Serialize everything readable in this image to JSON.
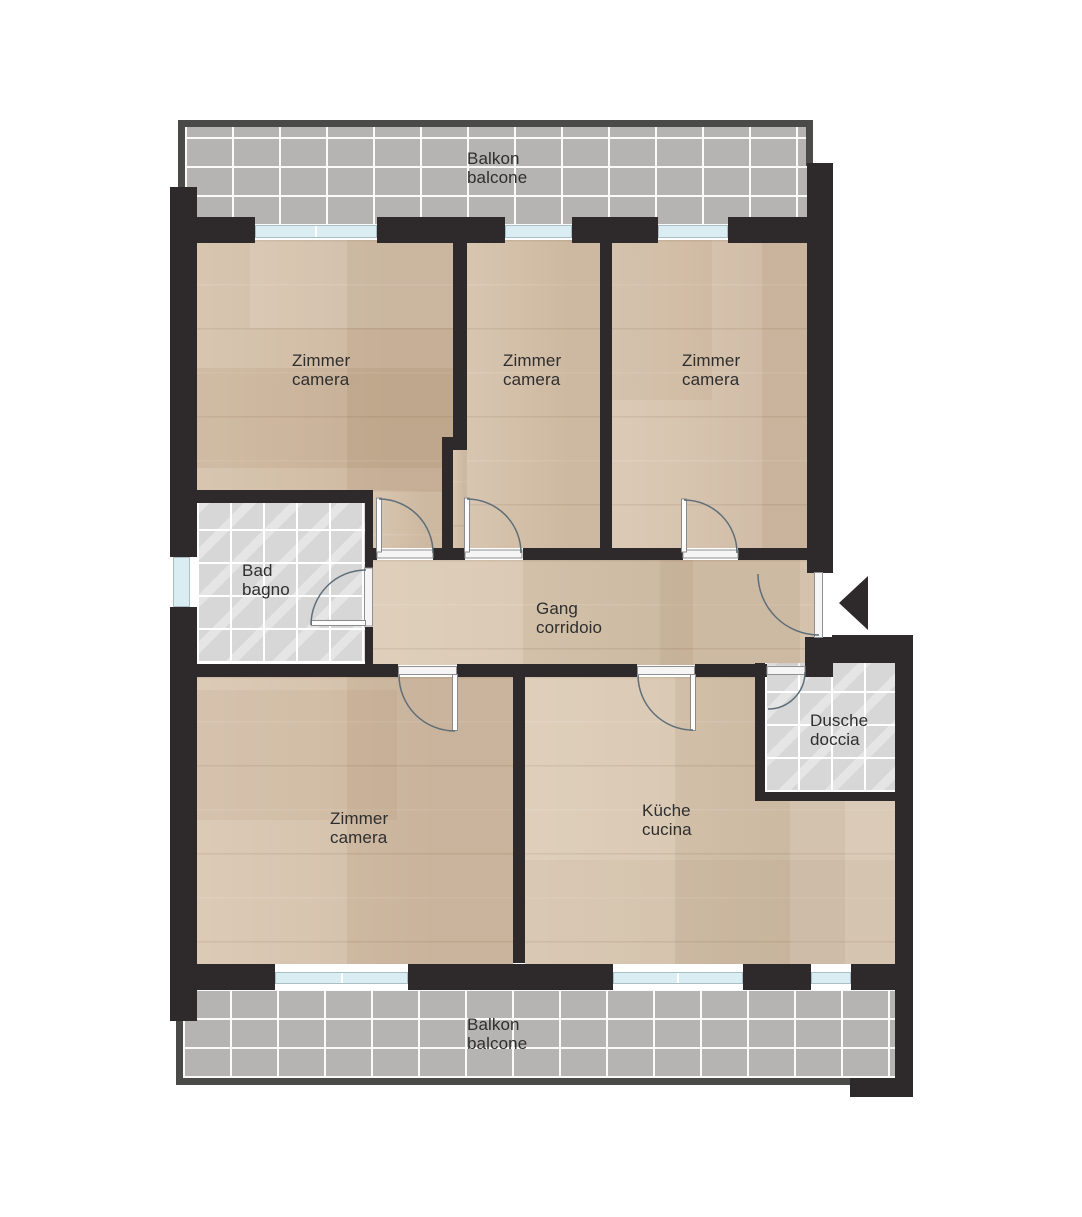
{
  "plan": {
    "rooms": [
      {
        "id": "balcony-top",
        "line1": "Balkon",
        "line2": "balcone"
      },
      {
        "id": "zimmer-top-left",
        "line1": "Zimmer",
        "line2": "camera"
      },
      {
        "id": "zimmer-top-middle",
        "line1": "Zimmer",
        "line2": "camera"
      },
      {
        "id": "zimmer-top-right",
        "line1": "Zimmer",
        "line2": "camera"
      },
      {
        "id": "bad",
        "line1": "Bad",
        "line2": "bagno"
      },
      {
        "id": "gang",
        "line1": "Gang",
        "line2": "corridoio"
      },
      {
        "id": "dusche",
        "line1": "Dusche",
        "line2": "doccia"
      },
      {
        "id": "zimmer-bottom",
        "line1": "Zimmer",
        "line2": "camera"
      },
      {
        "id": "kueche",
        "line1": "Küche",
        "line2": "cucina"
      },
      {
        "id": "balcony-bottom",
        "line1": "Balkon",
        "line2": "balcone"
      }
    ],
    "colors": {
      "wall": "#2e292a",
      "balcony_rail": "#4a4a49",
      "wood_floor": "#d2bda5",
      "corridor_floor": "#d9c8b2",
      "balcony_tile": "#b5b4b3",
      "bath_tile": "#d7d7d7",
      "tile_grout": "#ffffff",
      "window_glass": "#d9edf3",
      "door_swing_line": "#5f6e78",
      "threshold": "#f5f5f5",
      "label_text": "#2e2e2e"
    }
  }
}
